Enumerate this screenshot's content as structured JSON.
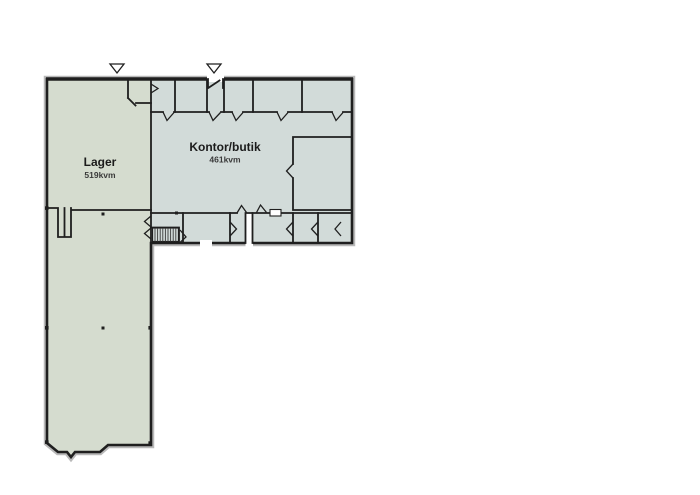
{
  "canvas": {
    "background": "#ffffff"
  },
  "floorplan": {
    "rooms": {
      "lager": {
        "label": "Lager",
        "area": "519kvm",
        "fill": "#d5dccf"
      },
      "kontor": {
        "label": "Kontor/butik",
        "area": "461kvm",
        "fill": "#d2dbd9"
      }
    },
    "colors": {
      "wall": "#1f1f1f",
      "wall_halo": "#b9b9b9",
      "hatch": "#3c3c3c",
      "marker_fill": "#ffffff"
    },
    "icons": {
      "entrance_marker": "triangle-down"
    }
  }
}
